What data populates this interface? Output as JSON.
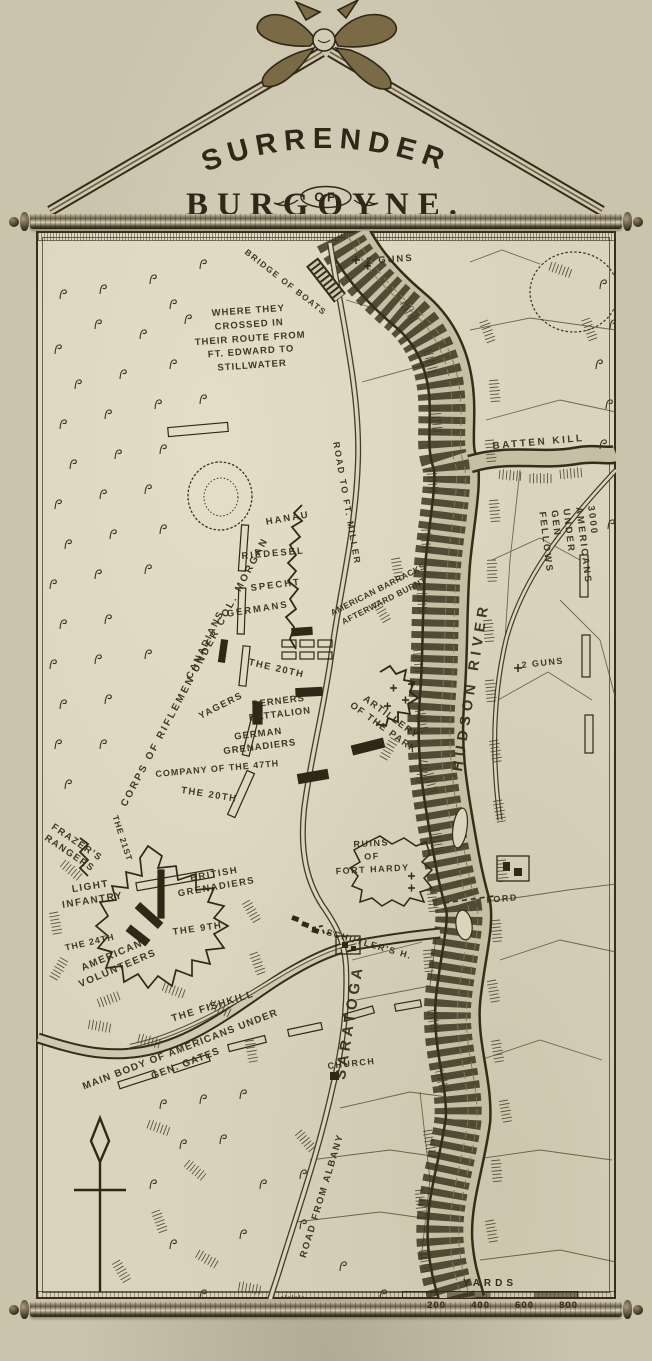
{
  "title": {
    "line1": "SURRENDER",
    "line2": "OF",
    "line3": "BURGOYNE."
  },
  "colors": {
    "page_bg": "#cbc4ad",
    "paper": "#dbd3bc",
    "ink": "#342c19",
    "river": "#c6bfa4"
  },
  "icons": {
    "compass": "north-arrow",
    "hanger": "ribbon-bow"
  },
  "scale_bar": {
    "title": "YARDS",
    "ticks": [
      "200",
      "400",
      "600",
      "800"
    ]
  },
  "labels": [
    {
      "id": "bridge-of-boats",
      "text": "BRIDGE OF BOATS",
      "x": 249,
      "y": 247,
      "rot": 38,
      "size": 8.5,
      "sp": 1.5
    },
    {
      "id": "two-guns-north",
      "text": "2 GUNS",
      "x": 366,
      "y": 256,
      "rot": -4,
      "size": 9.5,
      "sp": 2
    },
    {
      "id": "crossing-note",
      "text": "WHERE THEY\nCROSSED IN\nTHEIR ROUTE FROM\nFT. EDWARD TO\nSTILLWATER",
      "x": 168,
      "y": 310,
      "rot": -4,
      "size": 9.5,
      "sp": 1,
      "align": "center",
      "w": 160,
      "lh": 1.45
    },
    {
      "id": "batten-kill",
      "text": "BATTEN KILL",
      "x": 492,
      "y": 440,
      "rot": -5,
      "size": 10,
      "sp": 2.5
    },
    {
      "id": "americans-fellows",
      "text": "3000 AMERICANS UNDER GEN. FELLOWS",
      "x": 596,
      "y": 505,
      "rot": 83,
      "size": 9.5,
      "sp": 2.2
    },
    {
      "id": "two-guns-east",
      "text": "2 GUNS",
      "x": 521,
      "y": 660,
      "rot": -6,
      "size": 9,
      "sp": 1.5
    },
    {
      "id": "hudson-river",
      "text": "HUDSON RIVER",
      "x": 449,
      "y": 770,
      "rot": -81,
      "size": 14.5,
      "sp": 5
    },
    {
      "id": "road-to-ft-miller",
      "text": "ROAD TO FT. MILLER",
      "x": 341,
      "y": 441,
      "rot": 80,
      "size": 9,
      "sp": 1.8
    },
    {
      "id": "corps-riflemen",
      "text": "CORPS OF RIFLEMEN UNDER COL. MORGAN",
      "x": 118,
      "y": 803,
      "rot": -62,
      "size": 10,
      "sp": 2.4
    },
    {
      "id": "canadians",
      "text": "CANADIANS",
      "x": 184,
      "y": 676,
      "rot": -64,
      "size": 9.5,
      "sp": 2
    },
    {
      "id": "hanau",
      "text": "HANAU",
      "x": 265,
      "y": 517,
      "rot": -10,
      "size": 9.5,
      "sp": 2
    },
    {
      "id": "riedesel",
      "text": "RIEDESEL",
      "x": 241,
      "y": 551,
      "rot": -5,
      "size": 9.5,
      "sp": 2
    },
    {
      "id": "specht",
      "text": "SPECHT",
      "x": 250,
      "y": 583,
      "rot": -7,
      "size": 9.5,
      "sp": 2
    },
    {
      "id": "germans",
      "text": "GERMANS",
      "x": 226,
      "y": 609,
      "rot": -9,
      "size": 9.5,
      "sp": 2
    },
    {
      "id": "american-barracks",
      "text": "AMERICAN BARRACKS\nAFTERWARD BURNT",
      "x": 320,
      "y": 612,
      "rot": -27,
      "size": 8.5,
      "sp": 0.5,
      "align": "center",
      "w": 124,
      "lh": 1.5
    },
    {
      "id": "the-20th-a",
      "text": "THE 20TH",
      "x": 250,
      "y": 657,
      "rot": 13,
      "size": 9.5,
      "sp": 1.5
    },
    {
      "id": "yagers",
      "text": "YAGERS",
      "x": 197,
      "y": 712,
      "rot": -27,
      "size": 9.5,
      "sp": 1.5
    },
    {
      "id": "berners-battalion",
      "text": "BERNERS\nBATTALION",
      "x": 238,
      "y": 701,
      "rot": -7,
      "size": 9.5,
      "sp": 1,
      "align": "center",
      "w": 80,
      "lh": 1.35
    },
    {
      "id": "german-grenadiers",
      "text": "GERMAN\nGRENADIERS",
      "x": 207,
      "y": 735,
      "rot": -7,
      "size": 9.5,
      "sp": 1,
      "align": "center",
      "w": 102,
      "lh": 1.35
    },
    {
      "id": "company-47th",
      "text": "COMPANY OF THE 47TH",
      "x": 155,
      "y": 769,
      "rot": -5,
      "size": 9,
      "sp": 1
    },
    {
      "id": "the-20th-b",
      "text": "THE 20TH",
      "x": 182,
      "y": 785,
      "rot": 9,
      "size": 9.5,
      "sp": 1.5
    },
    {
      "id": "artillery-park",
      "text": "ARTILLERY\nOF THE PARK",
      "x": 356,
      "y": 684,
      "rot": 36,
      "size": 9.5,
      "sp": 1.5,
      "align": "center",
      "w": 96,
      "lh": 1.4
    },
    {
      "id": "ford",
      "text": "FORD",
      "x": 486,
      "y": 895,
      "rot": -5,
      "size": 9,
      "sp": 1.5
    },
    {
      "id": "frazers-rangers",
      "text": "FRAZER'S\nRANGERS",
      "x": 50,
      "y": 818,
      "rot": 34,
      "size": 9.5,
      "sp": 1.5,
      "align": "center",
      "w": 72,
      "lh": 1.35
    },
    {
      "id": "the-21st",
      "text": "THE 21ST",
      "x": 120,
      "y": 814,
      "rot": 72,
      "size": 8.5,
      "sp": 1
    },
    {
      "id": "light-infantry",
      "text": "LIGHT\nINFANTRY",
      "x": 48,
      "y": 887,
      "rot": -9,
      "size": 10,
      "sp": 1.5,
      "align": "center",
      "w": 84,
      "lh": 1.4
    },
    {
      "id": "british-grenadiers",
      "text": "BRITISH\nGRENADIERS",
      "x": 168,
      "y": 877,
      "rot": -10,
      "size": 9.5,
      "sp": 1.5,
      "align": "center",
      "w": 92,
      "lh": 1.35
    },
    {
      "id": "the-9th",
      "text": "THE 9TH",
      "x": 172,
      "y": 927,
      "rot": -8,
      "size": 9.5,
      "sp": 1.5
    },
    {
      "id": "the-24th",
      "text": "THE 24TH",
      "x": 64,
      "y": 943,
      "rot": -13,
      "size": 9,
      "sp": 1
    },
    {
      "id": "american-volunteers",
      "text": "AMERICAN\nVOLUNTEERS",
      "x": 60,
      "y": 971,
      "rot": -23,
      "size": 10,
      "sp": 1.5,
      "align": "center",
      "w": 108,
      "lh": 1.4
    },
    {
      "id": "ruins-fort-hardy",
      "text": "RUINS\nOF\nFORT HARDY",
      "x": 320,
      "y": 840,
      "rot": -3,
      "size": 9,
      "sp": 1.5,
      "align": "center",
      "w": 102,
      "lh": 1.45
    },
    {
      "id": "schuylers-h",
      "text": "SCHUYLER'S H.",
      "x": 328,
      "y": 927,
      "rot": 16,
      "size": 9,
      "sp": 1.5
    },
    {
      "id": "saratoga",
      "text": "SARATOGA",
      "x": 331,
      "y": 1078,
      "rot": -81,
      "size": 15,
      "sp": 4
    },
    {
      "id": "the-fishkill",
      "text": "THE FISHKILL",
      "x": 170,
      "y": 1013,
      "rot": -17,
      "size": 10,
      "sp": 1.5
    },
    {
      "id": "main-body-gates",
      "text": "MAIN BODY OF AMERICANS UNDER\nGEN. GATES",
      "x": 76,
      "y": 1082,
      "rot": -21,
      "size": 10,
      "sp": 1.2,
      "align": "center",
      "w": 218,
      "lh": 1.5
    },
    {
      "id": "church",
      "text": "CHURCH",
      "x": 327,
      "y": 1061,
      "rot": -6,
      "size": 9,
      "sp": 1.5
    },
    {
      "id": "road-from-albany",
      "text": "ROAD FROM ALBANY",
      "x": 298,
      "y": 1256,
      "rot": -73,
      "size": 9.5,
      "sp": 1.8
    }
  ]
}
